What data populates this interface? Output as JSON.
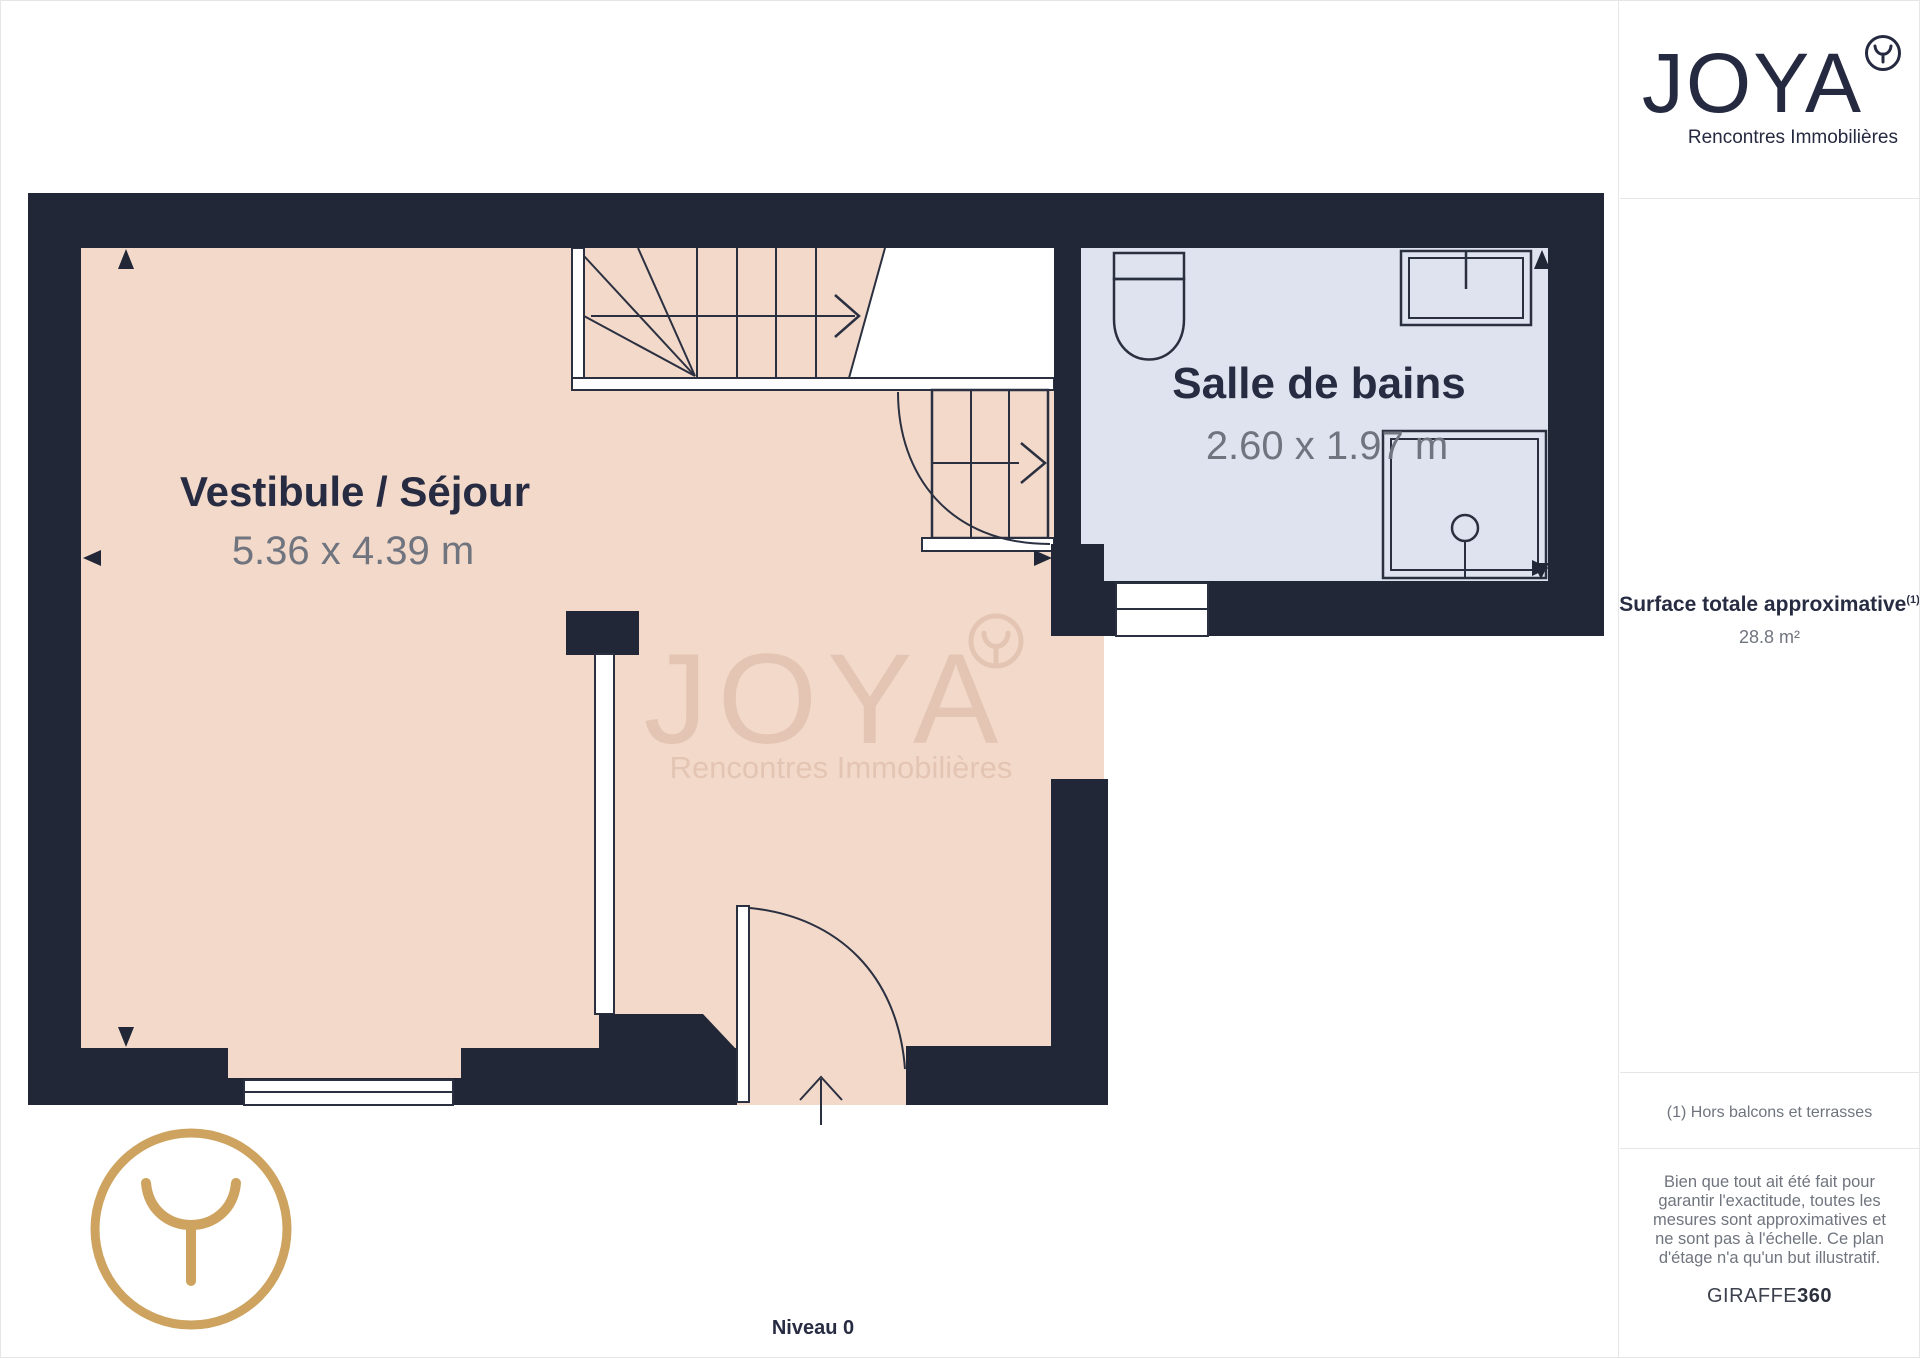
{
  "brand": {
    "name": "JOYA",
    "tagline": "Rencontres Immobilières"
  },
  "sidebar": {
    "surface": {
      "label": "Surface totale approximative",
      "sup": "(1)",
      "value": "28.8 m²"
    },
    "footnote": "(1) Hors balcons et terrasses",
    "disclaimer": "Bien que tout ait été fait pour garantir l'exactitude, toutes les mesures sont approximatives et ne sont pas à l'échelle. Ce plan d'étage n'a qu'un but illustratif.",
    "credit": {
      "name": "GIRAFFE",
      "suffix": "360"
    }
  },
  "plan": {
    "level": "Niveau 0",
    "rooms": [
      {
        "id": "vestibule",
        "name": "Vestibule / Séjour",
        "dimensions": "5.36 x 4.39 m"
      },
      {
        "id": "bathroom",
        "name": "Salle de bains",
        "dimensions": "2.60 x 1.97 m"
      }
    ],
    "watermark": {
      "text": "JOYA",
      "tagline": "Rencontres Immobilières"
    }
  },
  "colors": {
    "wall": "#212737",
    "room": "#f2d9ca",
    "bathroom": "#dfe3ef",
    "accent_gold": "#cda35f",
    "label": "#272c42",
    "dim_text": "#70747e"
  }
}
